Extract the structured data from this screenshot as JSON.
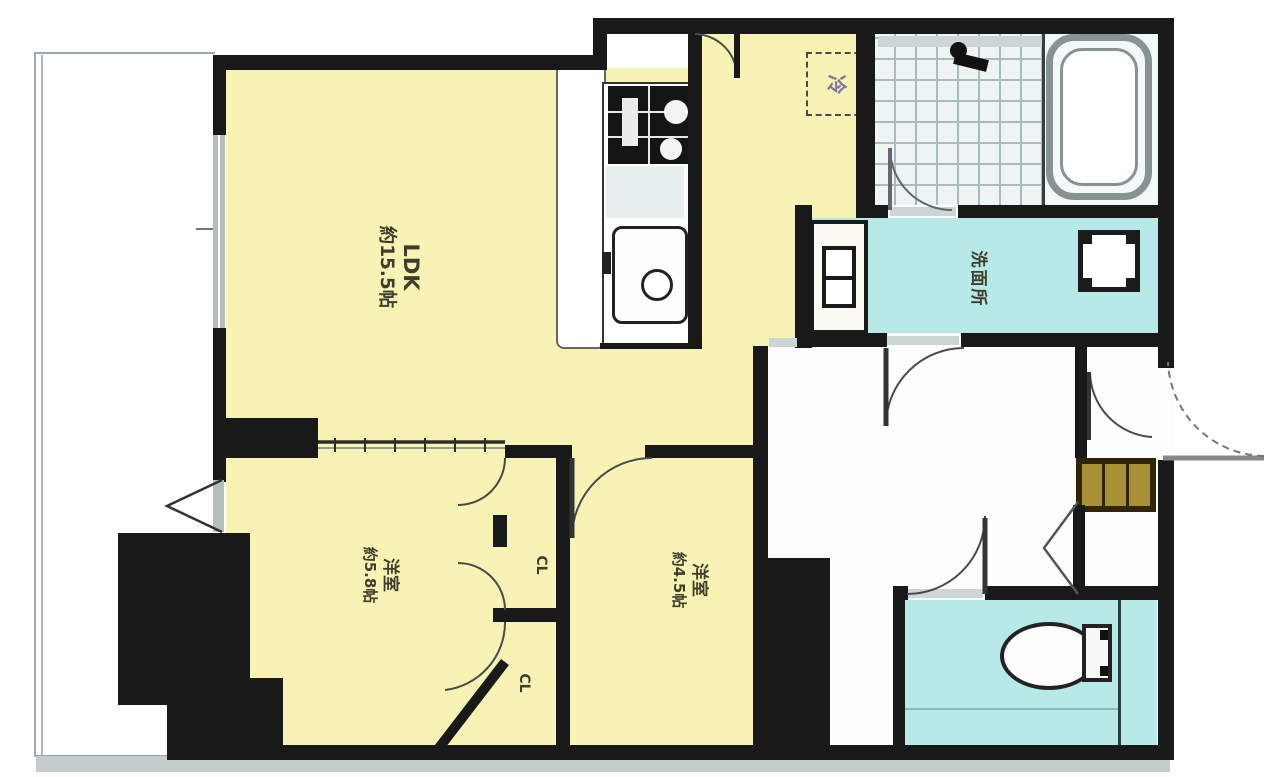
{
  "plan": {
    "type": "apartment-floor-plan",
    "rooms": {
      "ldk": {
        "name_label": "LDK",
        "size_label": "約15.5帖"
      },
      "bedroom_main": {
        "name_label": "洋室",
        "size_label": "約5.8帖"
      },
      "bedroom_second": {
        "name_label": "洋室",
        "size_label": "約4.5帖"
      },
      "washroom": {
        "name_label": "洗面所"
      },
      "closet_upper": {
        "name_label": "CL"
      },
      "closet_lower": {
        "name_label": "CL"
      },
      "refrigerator_space": {
        "name_label": "冷"
      }
    },
    "colors": {
      "room_yellow": "#f6f3b4",
      "wet_area_cyan": "#b7e9e6",
      "wall_black": "#191919",
      "bath_floor": "#eef4f4",
      "shoe_cabinet_tan": "#a98f35",
      "balcony_white": "#fefefe"
    }
  }
}
